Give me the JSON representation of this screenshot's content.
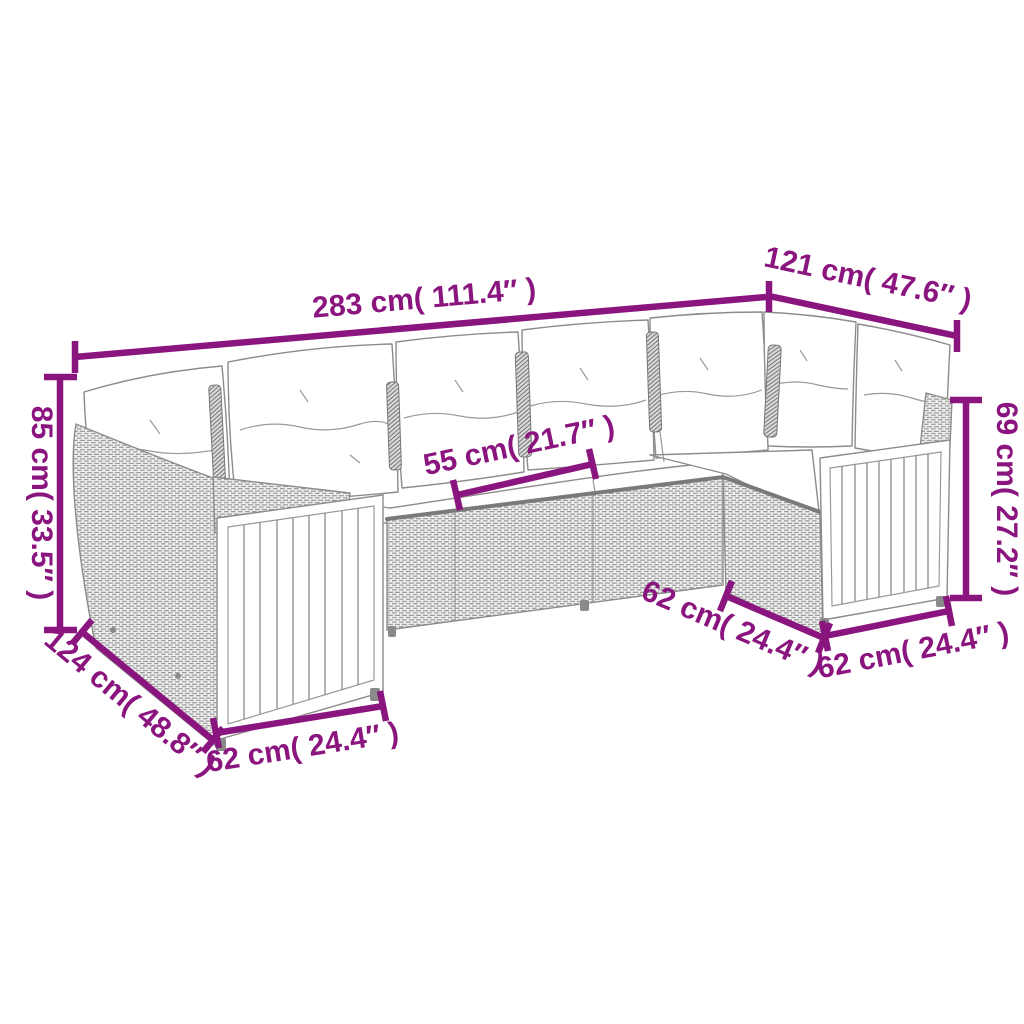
{
  "diagram_type": "furniture-dimension-diagram",
  "colors": {
    "dimension_accent": "#8B157E",
    "artwork_line": "#8C8C8C",
    "cushion_fill": "#FFFFFF",
    "background": "#FFFFFF"
  },
  "dimensions": [
    {
      "id": "back-total-width",
      "cm": "283",
      "inches": "111.4",
      "label": "283 cm( 111.4″ )"
    },
    {
      "id": "right-back-width",
      "cm": "121",
      "inches": "47.6",
      "label": "121 cm( 47.6″ )"
    },
    {
      "id": "back-height",
      "cm": "85",
      "inches": "33.5",
      "label": "85 cm( 33.5″ )"
    },
    {
      "id": "left-side-depth",
      "cm": "124",
      "inches": "48.8",
      "label": "124 cm( 48.8″ )"
    },
    {
      "id": "front-left-width",
      "cm": "62",
      "inches": "24.4",
      "label": "62 cm( 24.4″ )"
    },
    {
      "id": "seat-module-width",
      "cm": "55",
      "inches": "21.7",
      "label": "55 cm( 21.7″ )"
    },
    {
      "id": "right-arm-height",
      "cm": "69",
      "inches": "27.2",
      "label": "69 cm( 27.2″ )"
    },
    {
      "id": "right-inner-depth",
      "cm": "62",
      "inches": "24.4",
      "label": "62 cm( 24.4″ )"
    },
    {
      "id": "front-right-width",
      "cm": "62",
      "inches": "24.4",
      "label": "62 cm( 24.4″ )"
    }
  ]
}
